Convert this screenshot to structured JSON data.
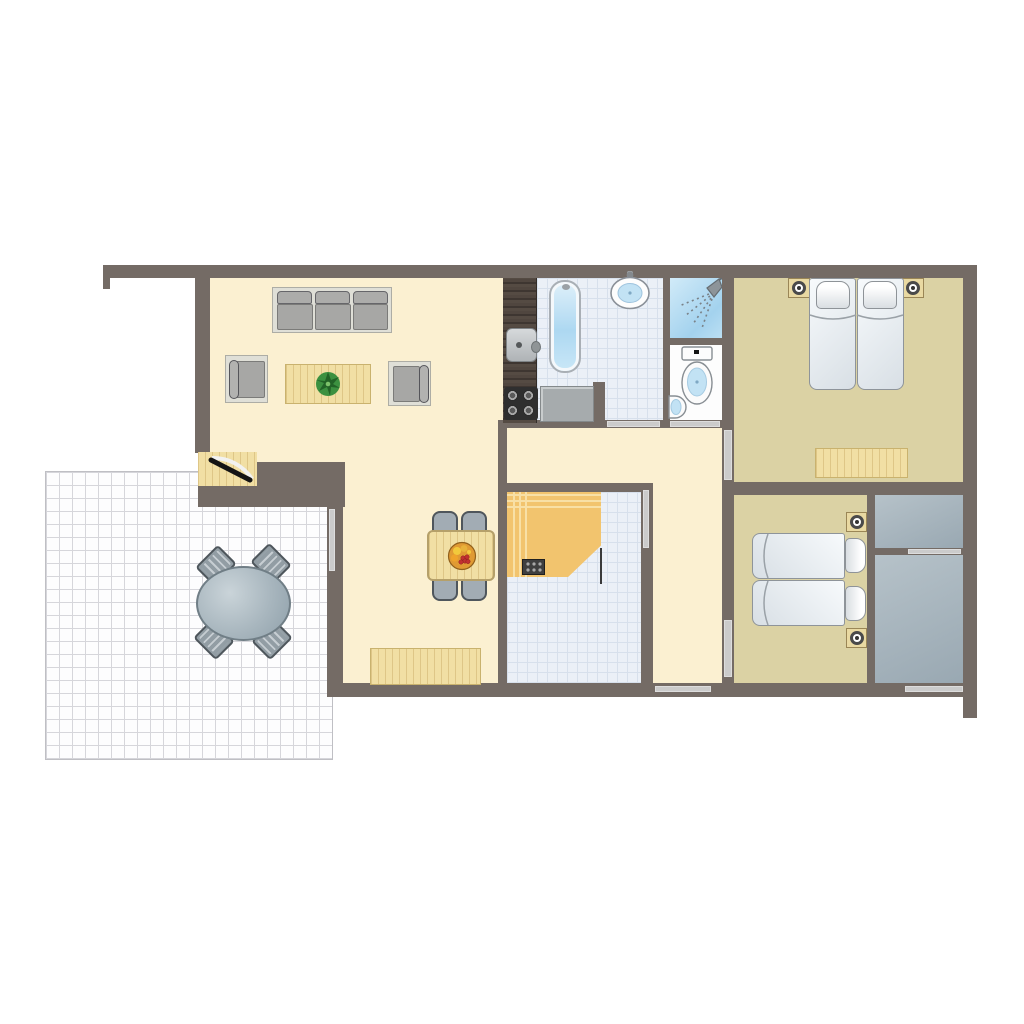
{
  "plan_title": "holiday-bungalow-floor-plan-top-view",
  "palette": {
    "wall": "#746B65",
    "floor_living": "#FBF0D1",
    "floor_bedroom": "#DBD2A4",
    "floor_storage": "#A4B2BB",
    "tile_bg": "#EBF0F7",
    "tile_line": "#D7E0EC",
    "terrace_bg": "#FDFDFE",
    "terrace_line": "#D6D6DB",
    "window_strip": "#CBCBCB",
    "wood": "#F1DFA4",
    "counter_dark": "#4A413A",
    "counter_gray": "#A6ABAD",
    "sofa_fabric": "#A7A7A5",
    "sofa_frame": "#DFDFD7",
    "mattress_white": "#F2F6F9",
    "fixture_blue": "#C2E2F4",
    "shower_blue": "#A3D2EE",
    "sauna_wood": "#F2C46E",
    "sauna_stripe": "#F8E0A6",
    "plant_green": "#3C9140",
    "fruit_orange": "#E09A33",
    "fruit_red": "#C23030"
  },
  "rooms": [
    {
      "id": "living-room",
      "floor": "cream"
    },
    {
      "id": "dining-area",
      "floor": "cream"
    },
    {
      "id": "kitchenette",
      "floor": "cream"
    },
    {
      "id": "hallway",
      "floor": "cream"
    },
    {
      "id": "bathroom",
      "floor": "tiles"
    },
    {
      "id": "shower",
      "floor": "blue"
    },
    {
      "id": "wc",
      "floor": "white"
    },
    {
      "id": "sauna-room",
      "floor": "tiles"
    },
    {
      "id": "bedroom-1",
      "floor": "tan"
    },
    {
      "id": "bedroom-2",
      "floor": "tan"
    },
    {
      "id": "storage-upper",
      "floor": "gray"
    },
    {
      "id": "storage-lower",
      "floor": "gray"
    },
    {
      "id": "terrace",
      "floor": "grid"
    }
  ],
  "furniture": {
    "living_room": [
      "three-seat-sofa",
      "armchair",
      "armchair",
      "coffee-table",
      "potted-plant"
    ],
    "kitchenette": [
      "kitchen-counter",
      "kitchen-sink",
      "stove-4-burners",
      "side-counter"
    ],
    "bathroom": [
      "bathtub",
      "wash-basin",
      "shower-head"
    ],
    "wc": [
      "toilet",
      "hand-basin"
    ],
    "sauna_room": [
      "sauna-bench",
      "sauna-heater",
      "glass-door-leaf"
    ],
    "dining_area": [
      "dining-table",
      "chair",
      "chair",
      "chair",
      "chair",
      "fruit-bowl",
      "wood-mat"
    ],
    "bedroom_1": [
      "double-bed",
      "nightstand-lamp",
      "nightstand-lamp",
      "wood-rug"
    ],
    "bedroom_2": [
      "twin-beds",
      "nightstand-lamp",
      "nightstand-lamp"
    ],
    "terrace": [
      "oval-table",
      "chair",
      "chair",
      "chair",
      "chair"
    ],
    "entrance": [
      "entry-door-swing",
      "wood-threshold"
    ]
  },
  "openings": {
    "doors": [
      "entry-door",
      "bathroom-door",
      "wc-door",
      "bedroom-1-door",
      "bedroom-2-door",
      "sauna-glass-door",
      "storage-sliding-door"
    ],
    "windows": [
      "terrace-side-window",
      "hall-south-window",
      "storage-south-window"
    ]
  }
}
